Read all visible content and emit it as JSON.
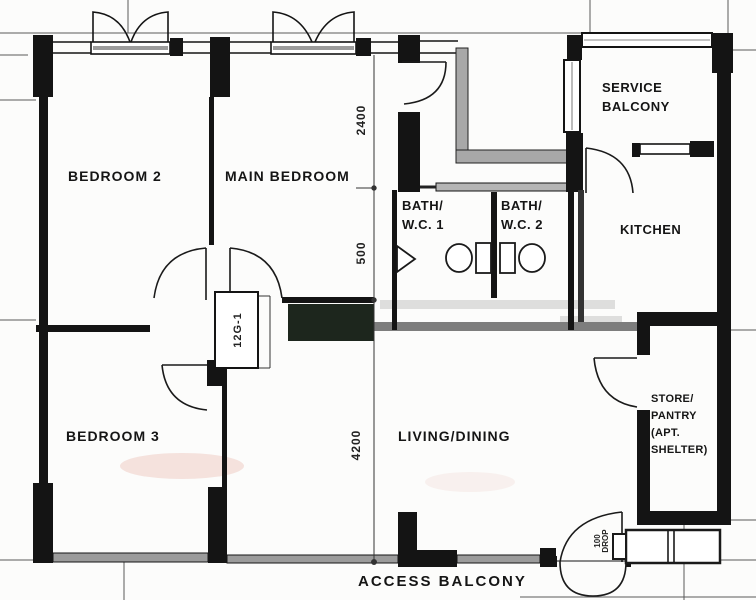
{
  "plan": {
    "rooms": {
      "bedroom2": "BEDROOM 2",
      "main_bedroom": "MAIN BEDROOM",
      "bedroom3": "BEDROOM 3",
      "living_dining": "LIVING/DINING",
      "kitchen": "KITCHEN",
      "service_balcony": [
        "SERVICE",
        "BALCONY"
      ],
      "bath_wc_1": [
        "BATH/",
        "W.C. 1"
      ],
      "bath_wc_2": [
        "BATH/",
        "W.C. 2"
      ],
      "store_pantry": [
        "STORE/",
        "PANTRY",
        "(APT.",
        "SHELTER)"
      ],
      "access_balcony": "ACCESS BALCONY"
    },
    "dimensions_mm": {
      "upper": "2400",
      "middle": "500",
      "lower": "4200"
    },
    "annotations": {
      "column_ref": "12G-1",
      "entrance_step": [
        "100",
        "DROP"
      ]
    },
    "colors": {
      "wall": "#141414",
      "window_gray": "#9b9b9b",
      "paper": "#fcfcfb",
      "smudge_green": "#1d261d",
      "smudge_pink": "#eec7c0"
    }
  }
}
